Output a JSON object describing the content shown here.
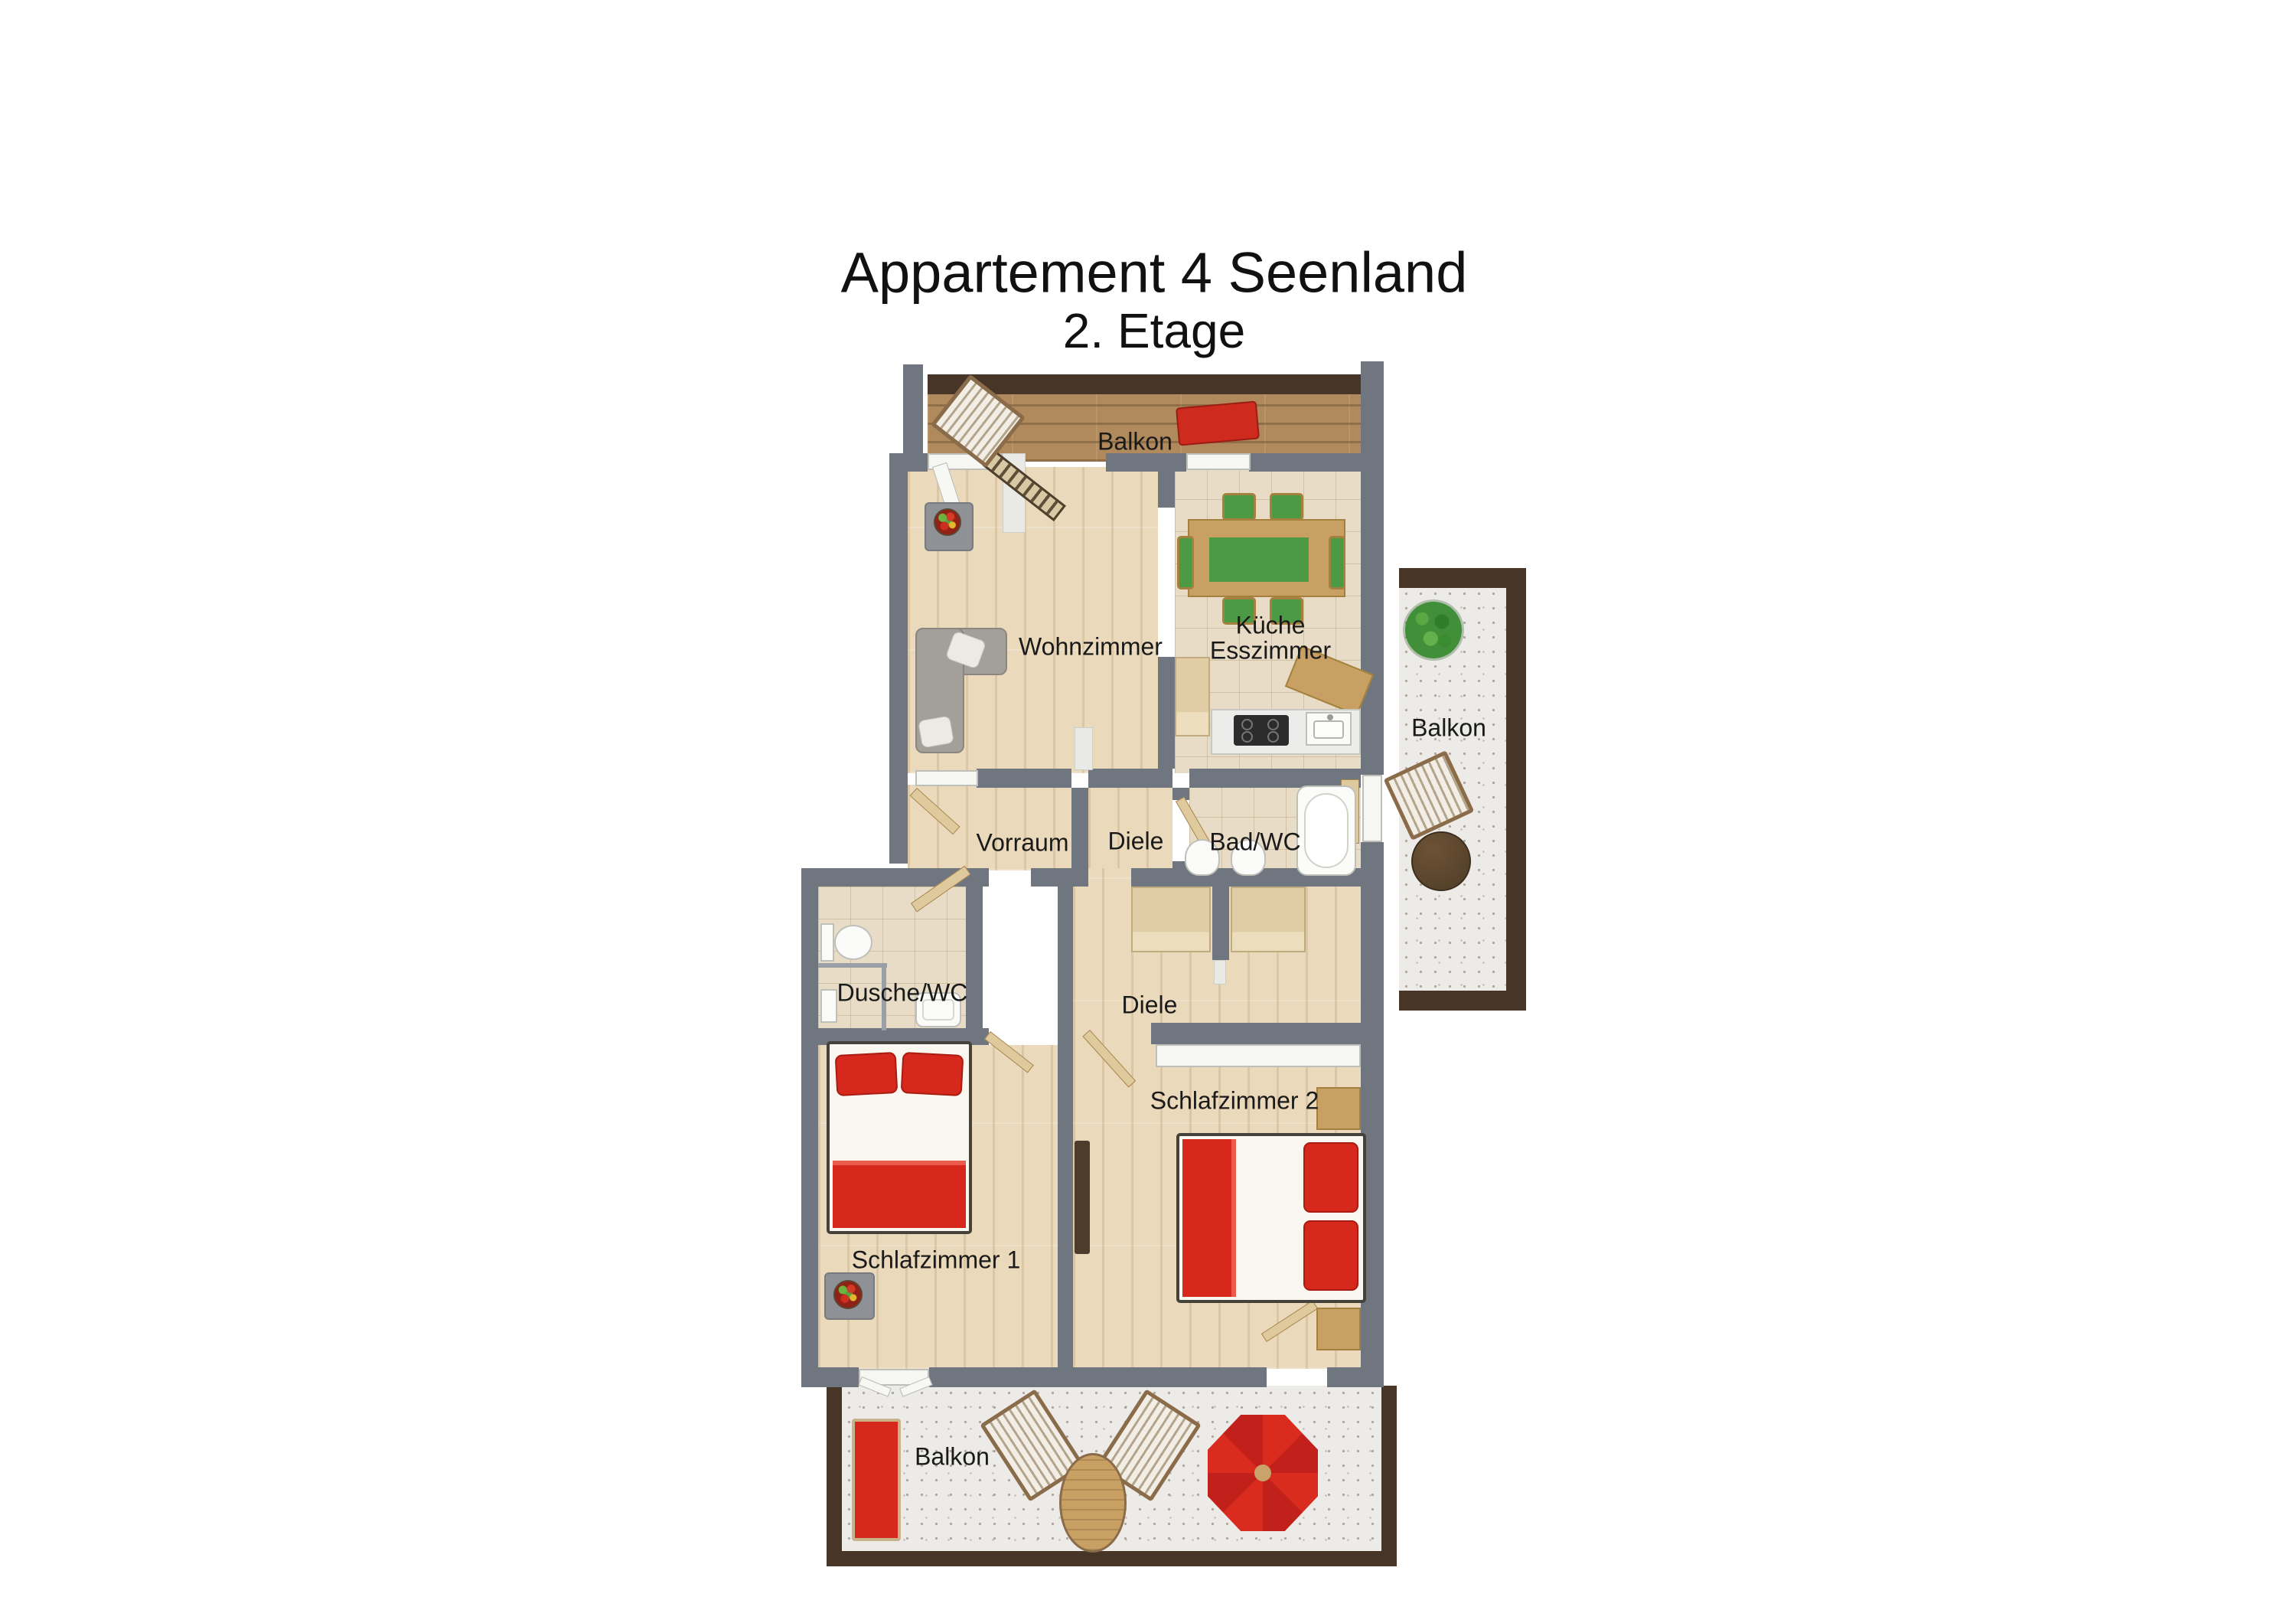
{
  "title": {
    "line1": "Appartement 4 Seenland",
    "line2": "2. Etage"
  },
  "rooms": {
    "balkon_top": "Balkon",
    "wohnzimmer": "Wohnzimmer",
    "kueche": "Küche",
    "esszimmer": "Esszimmer",
    "balkon_right": "Balkon",
    "vorraum": "Vorraum",
    "diele_upper": "Diele",
    "bad_wc": "Bad/WC",
    "dusche_wc": "Dusche/WC",
    "diele_lower": "Diele",
    "schlafzimmer_1": "Schlafzimmer 1",
    "schlafzimmer_2": "Schlafzimmer 2",
    "balkon_bottom": "Balkon"
  },
  "colors": {
    "wall": "#6f7680",
    "railing": "#473527",
    "floor_wood": "#ead9ba",
    "balcony_wood": "#b08a5c",
    "tile": "#e8dcc6",
    "speckle": "#edebe8",
    "bed_red": "#d6281d",
    "table_green": "#4c9b44",
    "sofa_gray": "#a39f99",
    "furniture_wood": "#c9a063"
  }
}
